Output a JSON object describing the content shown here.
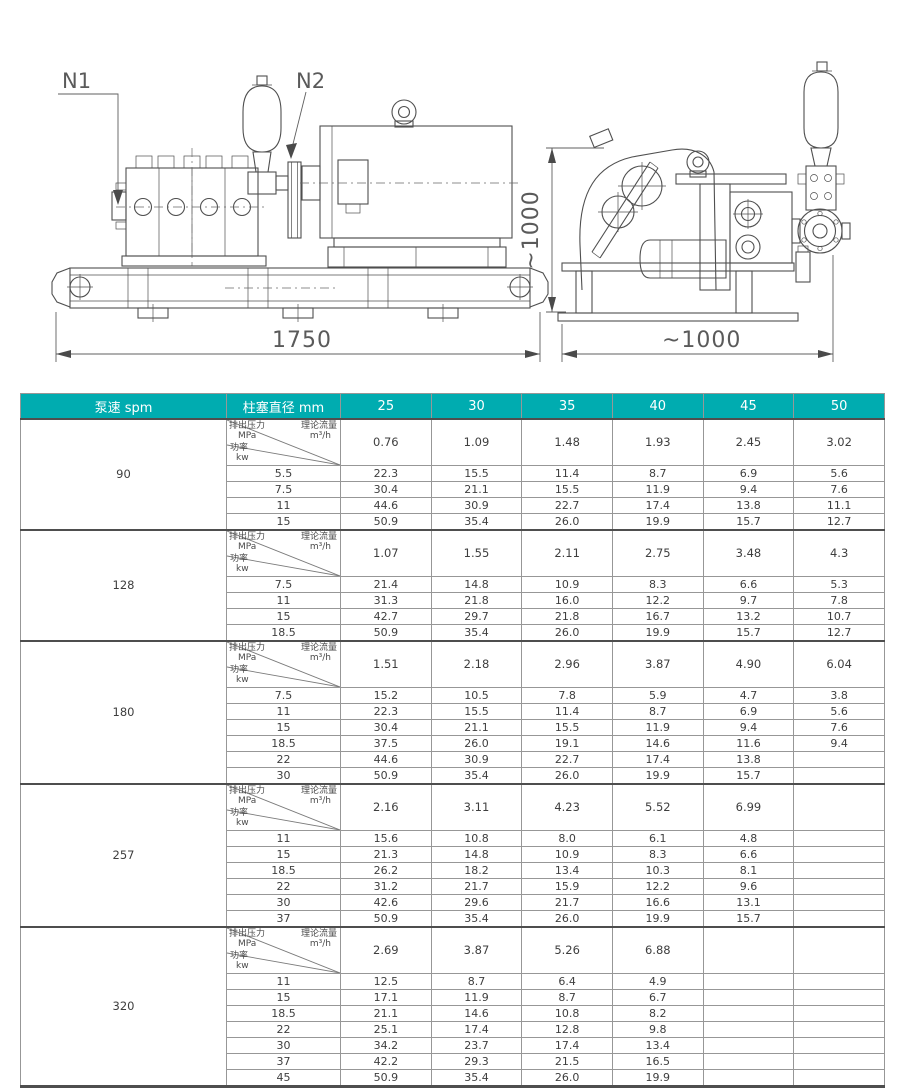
{
  "colors": {
    "header_teal": "#00acb0",
    "header_text": "#ffffff",
    "body_text": "#3e3e3e",
    "grid_line": "#979797",
    "thick_line": "#4e4e4e",
    "drawing_line": "#4f4f4f"
  },
  "drawing": {
    "n1": "N1",
    "n2": "N2",
    "length_dim": "1750",
    "height_dim": "~1000",
    "width_dim": "~1000"
  },
  "table": {
    "header": {
      "col_speed": "泵速  spm",
      "col_plunger": "柱塞直径 mm",
      "diameters": [
        "25",
        "30",
        "35",
        "40",
        "45",
        "50"
      ]
    },
    "corner": {
      "pressure_label": "排出压力",
      "pressure_unit": "MPa",
      "flow_label": "理论流量",
      "flow_unit": "m³/h",
      "power_label": "功率",
      "power_unit": "kw"
    },
    "groups": [
      {
        "speed": "90",
        "flow": [
          "0.76",
          "1.09",
          "1.48",
          "1.93",
          "2.45",
          "3.02"
        ],
        "rows": [
          {
            "pressure": "5.5",
            "values": [
              "22.3",
              "15.5",
              "11.4",
              "8.7",
              "6.9",
              "5.6"
            ]
          },
          {
            "pressure": "7.5",
            "values": [
              "30.4",
              "21.1",
              "15.5",
              "11.9",
              "9.4",
              "7.6"
            ]
          },
          {
            "pressure": "11",
            "values": [
              "44.6",
              "30.9",
              "22.7",
              "17.4",
              "13.8",
              "11.1"
            ]
          },
          {
            "pressure": "15",
            "values": [
              "50.9",
              "35.4",
              "26.0",
              "19.9",
              "15.7",
              "12.7"
            ]
          }
        ]
      },
      {
        "speed": "128",
        "flow": [
          "1.07",
          "1.55",
          "2.11",
          "2.75",
          "3.48",
          "4.3"
        ],
        "rows": [
          {
            "pressure": "7.5",
            "values": [
              "21.4",
              "14.8",
              "10.9",
              "8.3",
              "6.6",
              "5.3"
            ]
          },
          {
            "pressure": "11",
            "values": [
              "31.3",
              "21.8",
              "16.0",
              "12.2",
              "9.7",
              "7.8"
            ]
          },
          {
            "pressure": "15",
            "values": [
              "42.7",
              "29.7",
              "21.8",
              "16.7",
              "13.2",
              "10.7"
            ]
          },
          {
            "pressure": "18.5",
            "values": [
              "50.9",
              "35.4",
              "26.0",
              "19.9",
              "15.7",
              "12.7"
            ]
          }
        ]
      },
      {
        "speed": "180",
        "flow": [
          "1.51",
          "2.18",
          "2.96",
          "3.87",
          "4.90",
          "6.04"
        ],
        "rows": [
          {
            "pressure": "7.5",
            "values": [
              "15.2",
              "10.5",
              "7.8",
              "5.9",
              "4.7",
              "3.8"
            ]
          },
          {
            "pressure": "11",
            "values": [
              "22.3",
              "15.5",
              "11.4",
              "8.7",
              "6.9",
              "5.6"
            ]
          },
          {
            "pressure": "15",
            "values": [
              "30.4",
              "21.1",
              "15.5",
              "11.9",
              "9.4",
              "7.6"
            ]
          },
          {
            "pressure": "18.5",
            "values": [
              "37.5",
              "26.0",
              "19.1",
              "14.6",
              "11.6",
              "9.4"
            ]
          },
          {
            "pressure": "22",
            "values": [
              "44.6",
              "30.9",
              "22.7",
              "17.4",
              "13.8",
              ""
            ]
          },
          {
            "pressure": "30",
            "values": [
              "50.9",
              "35.4",
              "26.0",
              "19.9",
              "15.7",
              ""
            ]
          }
        ]
      },
      {
        "speed": "257",
        "flow": [
          "2.16",
          "3.11",
          "4.23",
          "5.52",
          "6.99",
          ""
        ],
        "rows": [
          {
            "pressure": "11",
            "values": [
              "15.6",
              "10.8",
              "8.0",
              "6.1",
              "4.8",
              ""
            ]
          },
          {
            "pressure": "15",
            "values": [
              "21.3",
              "14.8",
              "10.9",
              "8.3",
              "6.6",
              ""
            ]
          },
          {
            "pressure": "18.5",
            "values": [
              "26.2",
              "18.2",
              "13.4",
              "10.3",
              "8.1",
              ""
            ]
          },
          {
            "pressure": "22",
            "values": [
              "31.2",
              "21.7",
              "15.9",
              "12.2",
              "9.6",
              ""
            ]
          },
          {
            "pressure": "30",
            "values": [
              "42.6",
              "29.6",
              "21.7",
              "16.6",
              "13.1",
              ""
            ]
          },
          {
            "pressure": "37",
            "values": [
              "50.9",
              "35.4",
              "26.0",
              "19.9",
              "15.7",
              ""
            ]
          }
        ]
      },
      {
        "speed": "320",
        "flow": [
          "2.69",
          "3.87",
          "5.26",
          "6.88",
          "",
          ""
        ],
        "rows": [
          {
            "pressure": "11",
            "values": [
              "12.5",
              "8.7",
              "6.4",
              "4.9",
              "",
              ""
            ]
          },
          {
            "pressure": "15",
            "values": [
              "17.1",
              "11.9",
              "8.7",
              "6.7",
              "",
              ""
            ]
          },
          {
            "pressure": "18.5",
            "values": [
              "21.1",
              "14.6",
              "10.8",
              "8.2",
              "",
              ""
            ]
          },
          {
            "pressure": "22",
            "values": [
              "25.1",
              "17.4",
              "12.8",
              "9.8",
              "",
              ""
            ]
          },
          {
            "pressure": "30",
            "values": [
              "34.2",
              "23.7",
              "17.4",
              "13.4",
              "",
              ""
            ]
          },
          {
            "pressure": "37",
            "values": [
              "42.2",
              "29.3",
              "21.5",
              "16.5",
              "",
              ""
            ]
          },
          {
            "pressure": "45",
            "values": [
              "50.9",
              "35.4",
              "26.0",
              "19.9",
              "",
              ""
            ]
          }
        ]
      }
    ]
  }
}
